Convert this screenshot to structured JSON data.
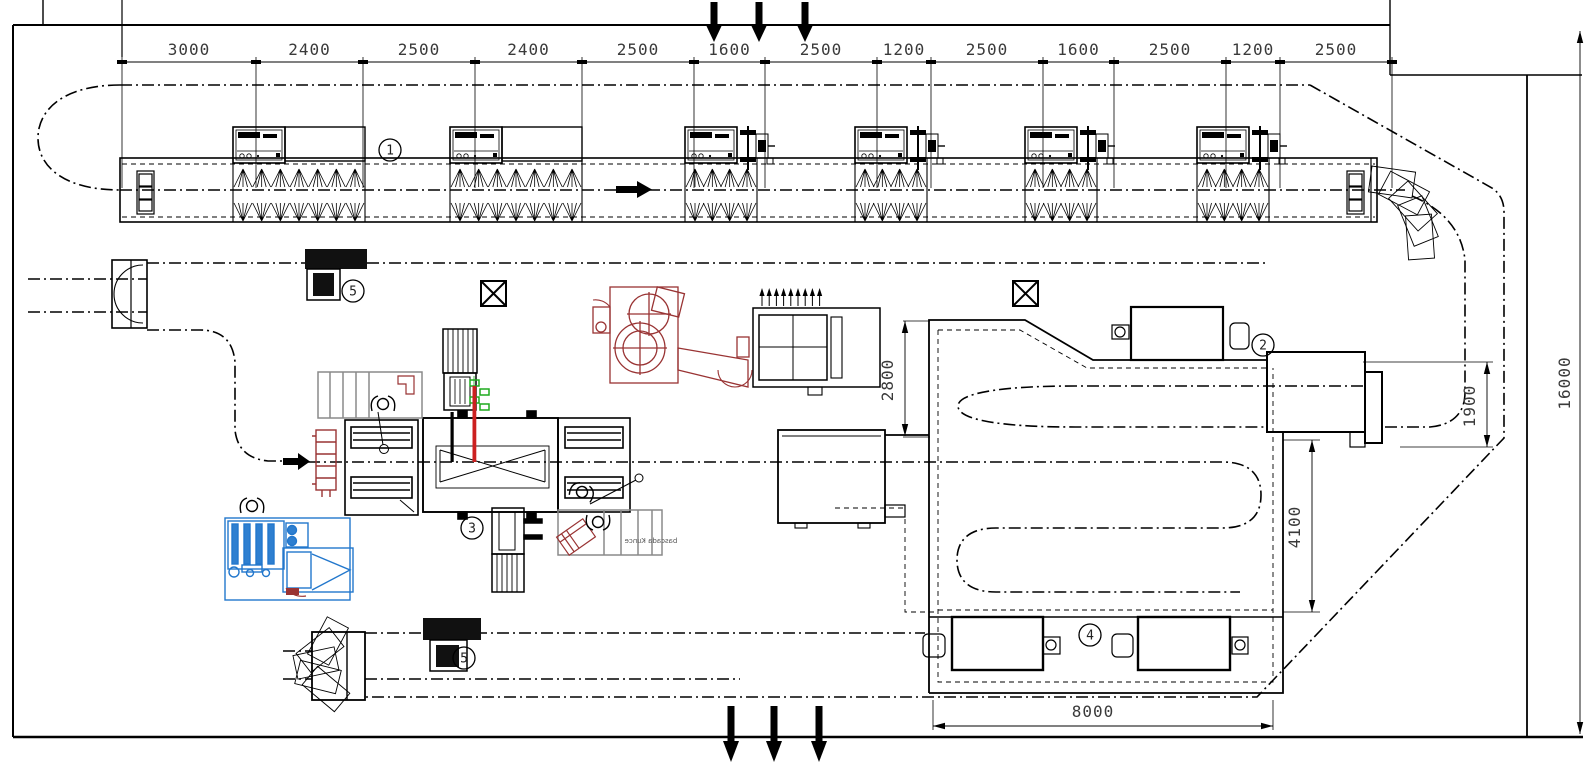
{
  "meta": {
    "title": "Production line layout plan",
    "type": "CAD floor plan drawing"
  },
  "colors": {
    "line": "#000000",
    "dim_text": "#3a3a3a",
    "maroon": "#993333",
    "red": "#cc2020",
    "blue": "#2277cc",
    "blue_fill": "#2e7fd0",
    "green": "#1faa1f",
    "grey": "#8a8a8a",
    "background": "#ffffff"
  },
  "top_dimension_chain": {
    "labels": [
      "3000",
      "2400",
      "2500",
      "2400",
      "2500",
      "1600",
      "2500",
      "1200",
      "2500",
      "1600",
      "2500",
      "1200",
      "2500"
    ],
    "boundaries_px": [
      122,
      256,
      363,
      475,
      582,
      694,
      765,
      877,
      931,
      1043,
      1114,
      1226,
      1280,
      1392
    ],
    "line_y": 62,
    "label_y": 55,
    "ext_top": 57,
    "ext_bottom": 188
  },
  "dimension_annotations": [
    {
      "id": "height-right",
      "label": "16000",
      "orient": "v",
      "x": 1580,
      "y1": 31,
      "y2": 734,
      "tx": 1570,
      "ty": 383
    },
    {
      "id": "loop-width",
      "label": "2800",
      "orient": "v",
      "x": 905,
      "y1": 321,
      "y2": 436,
      "tx": 893,
      "ty": 380
    },
    {
      "id": "outfeed-width",
      "label": "1900",
      "orient": "v",
      "x": 1487,
      "y1": 362,
      "y2": 447,
      "tx": 1475,
      "ty": 406
    },
    {
      "id": "storage-height",
      "label": "4100",
      "orient": "v",
      "x": 1312,
      "y1": 440,
      "y2": 612,
      "tx": 1300,
      "ty": 527
    },
    {
      "id": "storage-width",
      "label": "8000",
      "orient": "h",
      "y": 726,
      "x1": 933,
      "x2": 1273,
      "tx": 1093,
      "ty": 717
    }
  ],
  "station_labels": [
    {
      "num": "1",
      "x": 390,
      "y": 150
    },
    {
      "num": "2",
      "x": 1263,
      "y": 345
    },
    {
      "num": "3",
      "x": 472,
      "y": 528
    },
    {
      "num": "4",
      "x": 1090,
      "y": 635
    },
    {
      "num": "5",
      "x": 353,
      "y": 291
    },
    {
      "num": "5",
      "x": 464,
      "y": 658
    }
  ],
  "spray_line": {
    "station_count": 6,
    "machines": [
      {
        "x": 233,
        "type": "cabinet-ext"
      },
      {
        "x": 450,
        "type": "cabinet-ext"
      },
      {
        "x": 685,
        "type": "cabinet-pump"
      },
      {
        "x": 855,
        "type": "cabinet-pump"
      },
      {
        "x": 1025,
        "type": "cabinet-pump"
      },
      {
        "x": 1197,
        "type": "cabinet-pump"
      }
    ],
    "nozzles_ext": 7,
    "nozzles_pump": 4
  },
  "flow_arrows": {
    "inlet_top_x": [
      714,
      759,
      805
    ],
    "outlet_bottom_x": [
      731,
      774,
      819
    ]
  },
  "exhaust_unit": {
    "arrow_count": 9,
    "x0": 762,
    "dx": 7.2
  },
  "workstation_label": {
    "text": "bascada Kunce",
    "mirrored": true
  }
}
